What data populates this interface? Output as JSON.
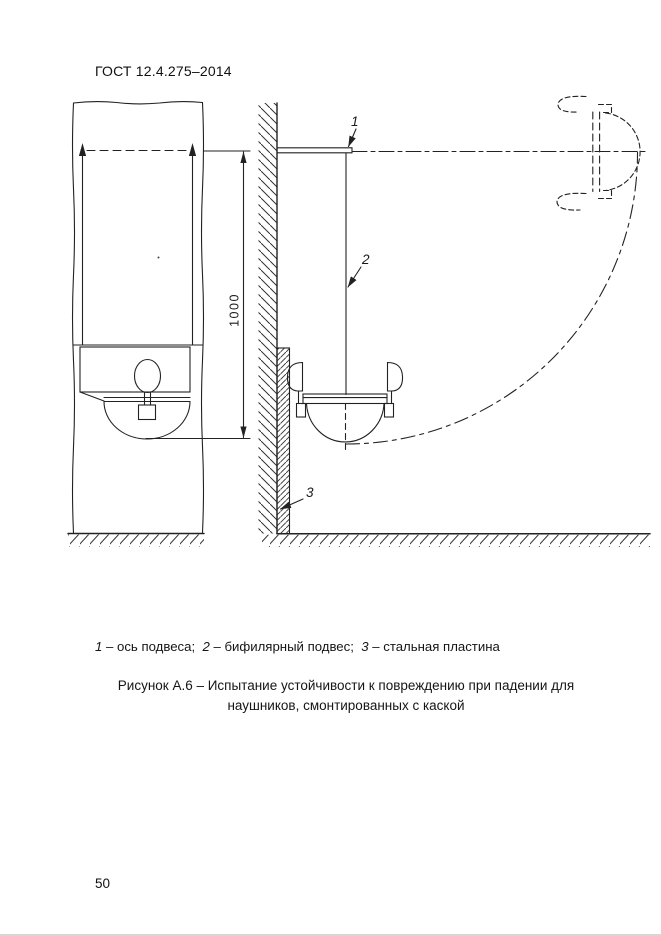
{
  "header": {
    "standard": "ГОСТ 12.4.275–2014"
  },
  "figure": {
    "callouts": {
      "c1": "1",
      "c2": "2",
      "c3": "3"
    },
    "dimension": {
      "value": "1000"
    }
  },
  "legend": {
    "items": [
      {
        "num": "1",
        "text": " – ось подвеса;  "
      },
      {
        "num": "2",
        "text": " – бифилярный подвес;  "
      },
      {
        "num": "3",
        "text": " – стальная пластина"
      }
    ]
  },
  "caption": {
    "line1": "Рисунок А.6 – Испытание устойчивости к повреждению при падении для",
    "line2": "наушников, смонтированных с каской"
  },
  "footer": {
    "page_number": "50"
  },
  "colors": {
    "ink": "#222222",
    "paper": "#ffffff"
  }
}
